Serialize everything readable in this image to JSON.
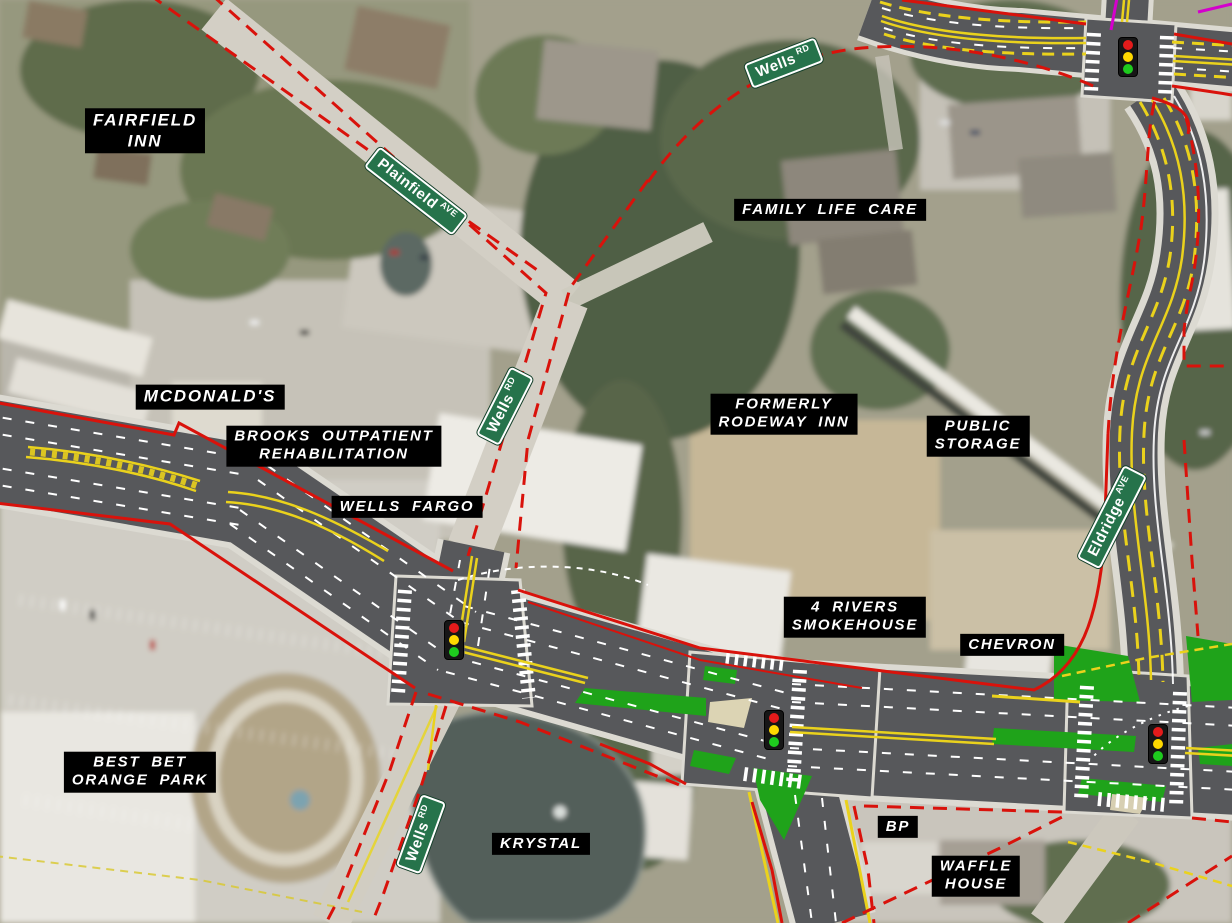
{
  "map": {
    "description": "Aerial photograph with proposed roadway improvement overlay, right-of-way lines and business labels",
    "road_signs": [
      {
        "id": "plainfield-ave",
        "name": "Plainfield",
        "suffix": "AVE"
      },
      {
        "id": "wells-rd-north",
        "name": "Wells",
        "suffix": "RD"
      },
      {
        "id": "wells-rd-middle",
        "name": "Wells",
        "suffix": "RD"
      },
      {
        "id": "eldridge-ave",
        "name": "Eldridge",
        "suffix": "AVE"
      },
      {
        "id": "wells-rd-south",
        "name": "Wells",
        "suffix": "RD"
      }
    ],
    "place_labels": [
      {
        "id": "fairfield-inn",
        "text": "FAIRFIELD\nINN"
      },
      {
        "id": "family-life-care",
        "text": "FAMILY LIFE CARE"
      },
      {
        "id": "mcdonalds",
        "text": "MCDONALD'S"
      },
      {
        "id": "brooks-outpatient-rehabilitation",
        "text": "BROOKS OUTPATIENT\nREHABILITATION"
      },
      {
        "id": "wells-fargo",
        "text": "WELLS FARGO"
      },
      {
        "id": "formerly-rodeway-inn",
        "text": "FORMERLY\nRODEWAY INN"
      },
      {
        "id": "public-storage",
        "text": "PUBLIC\nSTORAGE"
      },
      {
        "id": "four-rivers-smokehouse",
        "text": "4 RIVERS\nSMOKEHOUSE"
      },
      {
        "id": "chevron",
        "text": "CHEVRON"
      },
      {
        "id": "best-bet-orange-park",
        "text": "BEST BET\nORANGE PARK"
      },
      {
        "id": "krystal",
        "text": "KRYSTAL"
      },
      {
        "id": "bp",
        "text": "BP"
      },
      {
        "id": "waffle-house",
        "text": "WAFFLE\nHOUSE"
      }
    ],
    "traffic_signals": {
      "count": 4,
      "lens_colors": {
        "red": "#e31b1b",
        "yellow": "#ffd800",
        "green": "#1ecb1e"
      }
    },
    "colors": {
      "right_of_way_line_red": "#d9120b",
      "proposed_asphalt_gray": "#57585b",
      "existing_pavement_gray": "#d3cfc5",
      "curb_line_white": "#dcdad2",
      "lane_line_white": "#ffffff",
      "lane_line_yellow": "#ead21c",
      "turf_island_green": "#1fa31a",
      "concrete_island_tan": "#dcd4b4",
      "street_sign_green": "#26734b",
      "utility_line_magenta": "#d400cc",
      "pond_water": "#525e5a",
      "label_background": "#000000",
      "label_text": "#ffffff"
    }
  }
}
